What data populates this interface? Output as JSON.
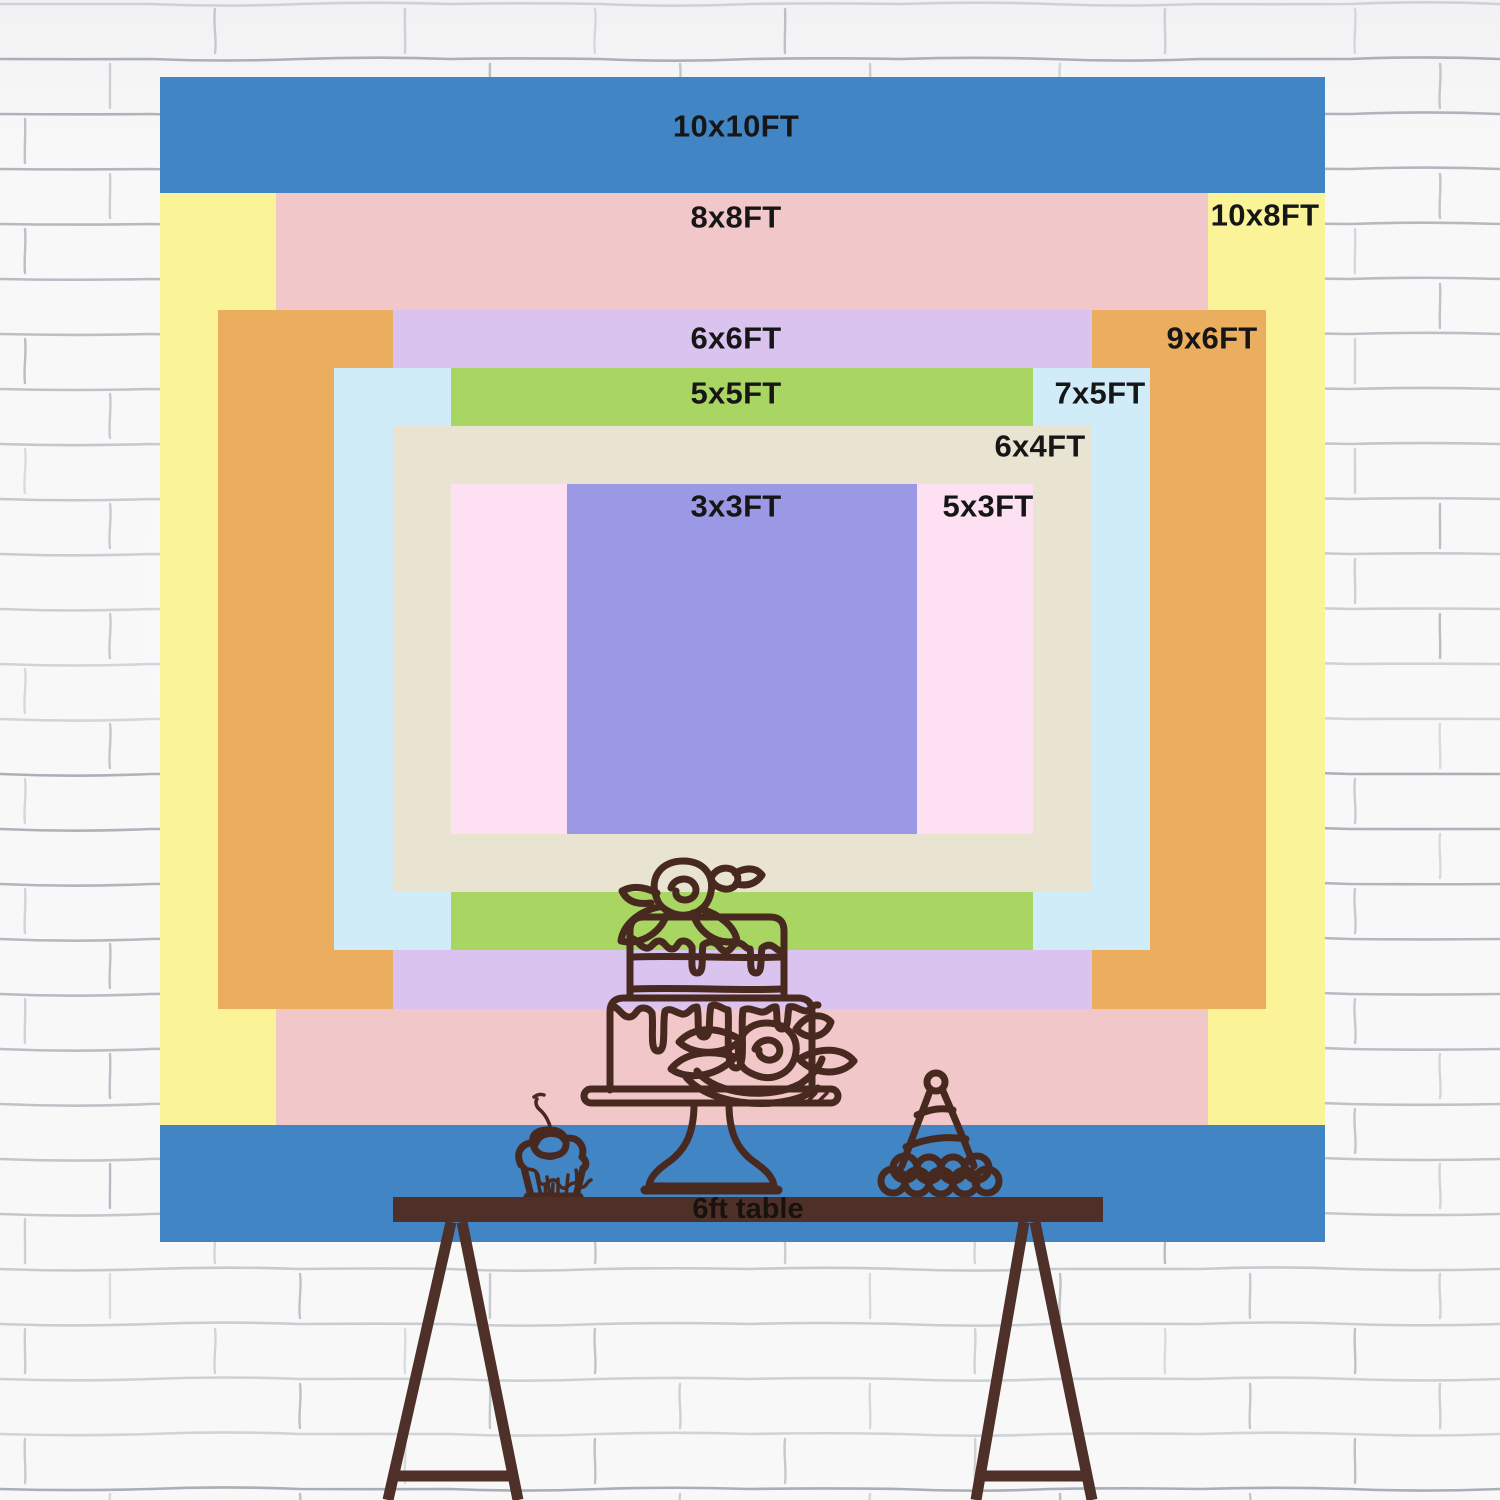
{
  "backdrop": {
    "px_per_ft": 116.5,
    "center_x": 742,
    "center_y": 659,
    "label_color": "#161616",
    "rects": [
      {
        "name": "10x10ft",
        "label": "10x10FT",
        "w_ft": 10,
        "h_ft": 10,
        "color": "#4285c5",
        "label_x": 736,
        "label_y": 127
      },
      {
        "name": "10x8ft",
        "label": "10x8FT",
        "w_ft": 10,
        "h_ft": 8,
        "color": "#faf398",
        "label_x": 1265,
        "label_y": 216
      },
      {
        "name": "8x8ft",
        "label": "8x8FT",
        "w_ft": 8,
        "h_ft": 8,
        "color": "#f2c7c9",
        "label_x": 736,
        "label_y": 218
      },
      {
        "name": "9x6ft",
        "label": "9x6FT",
        "w_ft": 9,
        "h_ft": 6,
        "color": "#ebae5f",
        "label_x": 1212,
        "label_y": 339
      },
      {
        "name": "6x6ft",
        "label": "6x6FT",
        "w_ft": 6,
        "h_ft": 6,
        "color": "#dbc3f0",
        "label_x": 736,
        "label_y": 339
      },
      {
        "name": "7x5ft",
        "label": "7x5FT",
        "w_ft": 7,
        "h_ft": 5,
        "color": "#cfecf8",
        "label_x": 1100,
        "label_y": 394
      },
      {
        "name": "5x5ft",
        "label": "5x5FT",
        "w_ft": 5,
        "h_ft": 5,
        "color": "#a9d662",
        "label_x": 736,
        "label_y": 394
      },
      {
        "name": "6x4ft",
        "label": "6x4FT",
        "w_ft": 6,
        "h_ft": 4,
        "color": "#e9e3d2",
        "label_x": 1040,
        "label_y": 447
      },
      {
        "name": "5x3ft",
        "label": "5x3FT",
        "w_ft": 5,
        "h_ft": 3,
        "color": "#fde0f2",
        "label_x": 988,
        "label_y": 507
      },
      {
        "name": "3x3ft",
        "label": "3x3FT",
        "w_ft": 3,
        "h_ft": 3,
        "color": "#9b99e6",
        "label_x": 736,
        "label_y": 507
      }
    ]
  },
  "table": {
    "label": "6ft table",
    "wood_color": "#4e3029",
    "text_color": "#18120e"
  },
  "illustrations": {
    "line_color": "#48291f",
    "items": [
      "birthday-cake",
      "cupcake-with-cherry",
      "party-hat"
    ]
  },
  "wall": {
    "base_color": "#f8f8f9",
    "mortar_color": "#8f959e"
  }
}
